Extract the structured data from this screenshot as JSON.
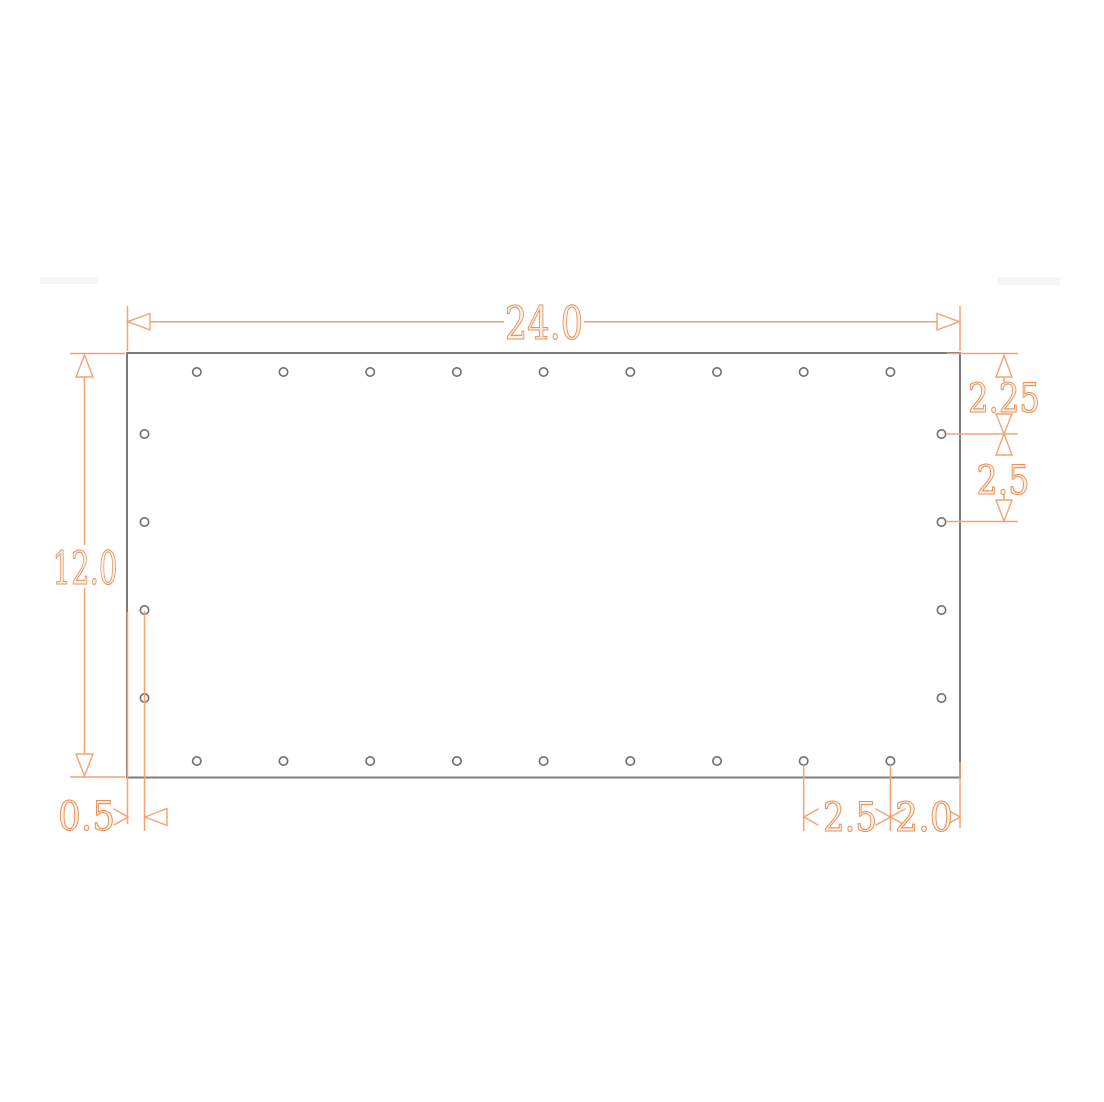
{
  "drawing": {
    "type": "dimensioned-panel-drawing",
    "units_shown": false,
    "colors": {
      "dimension_lines": "#f2a376",
      "dimension_text_stroke": "#e98f58",
      "dimension_text_fill": "#fdf1e7",
      "panel_outline": "#7c7c7c",
      "hole_outline": "#6f6f6f",
      "background": "#ffffff"
    },
    "dimensions": {
      "top_width": {
        "label": "24.0"
      },
      "left_height": {
        "label": "12.0"
      },
      "right_top_offset": {
        "label": "2.25"
      },
      "right_hole_spacing": {
        "label": "2.5"
      },
      "bottom_edge_offset": {
        "label": "0.5"
      },
      "bottom_hole_spacing": {
        "label": "2.5"
      },
      "bottom_corner_offset": {
        "label": "2.0"
      }
    },
    "holes": {
      "top_row": {
        "count": 9
      },
      "bottom_row": {
        "count": 9
      },
      "left_column": {
        "count": 4
      },
      "right_column": {
        "count": 4
      }
    }
  }
}
